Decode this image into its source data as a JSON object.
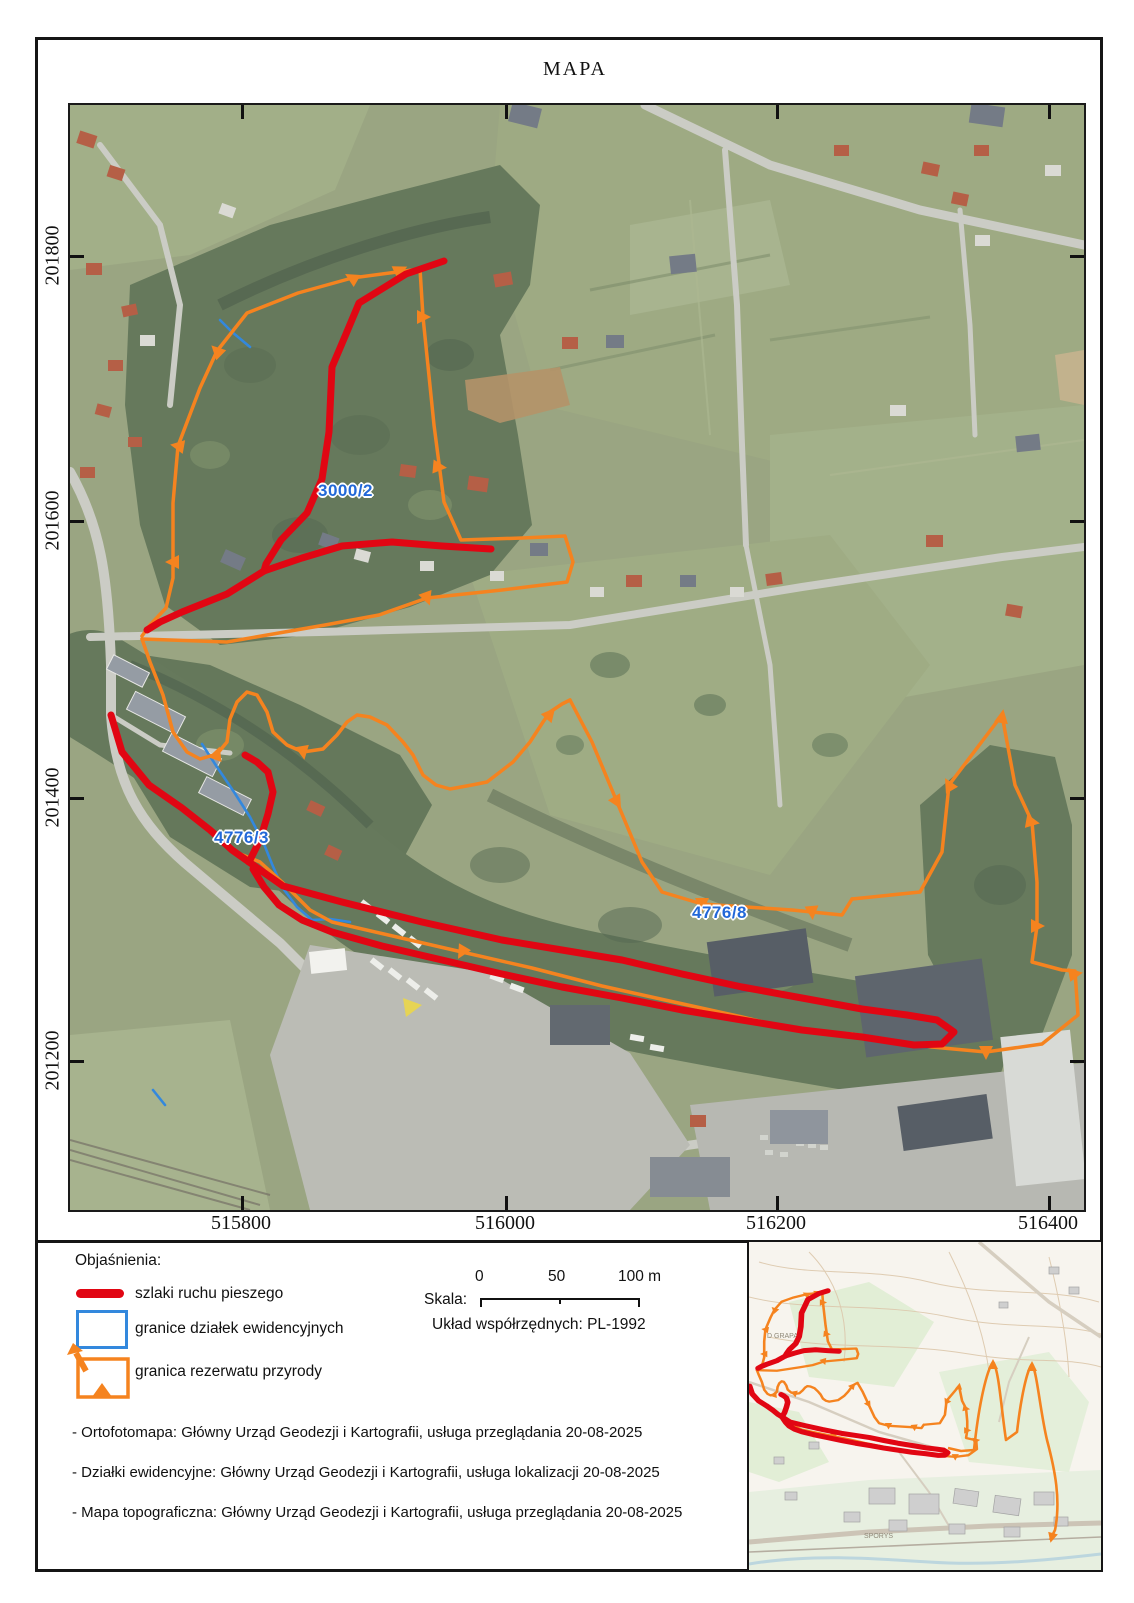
{
  "title": "MAPA",
  "axes": {
    "x_ticks": [
      "515800",
      "516000",
      "516200",
      "516400"
    ],
    "y_ticks": [
      "201800",
      "201600",
      "201400",
      "201200"
    ]
  },
  "map": {
    "parcel_labels": [
      {
        "text": "3000/2"
      },
      {
        "text": "4776/3"
      },
      {
        "text": "4776/8"
      }
    ]
  },
  "legend": {
    "heading": "Objaśnienia:",
    "items": [
      {
        "label": "szlaki ruchu pieszego"
      },
      {
        "label": "granice działek ewidencyjnych"
      },
      {
        "label": "granica rezerwatu przyrody"
      }
    ]
  },
  "scale": {
    "label": "Skala:",
    "tick0": "0",
    "tick50": "50",
    "tick100": "100 m",
    "crs": "Układ współrzędnych: PL-1992"
  },
  "sources": [
    "- Ortofotomapa: Główny Urząd Geodezji i Kartografii, usługa przeglądania 20-08-2025",
    "- Działki ewidencyjne: Główny Urząd Geodezji i Kartografii, usługa lokalizacji 20-08-2025",
    "- Mapa topograficzna: Główny Urząd Geodezji i Kartografii, usługa przeglądania 20-08-2025"
  ],
  "inset": {
    "labels": [
      {
        "text": "D GRAPA"
      },
      {
        "text": "SPORYS"
      }
    ]
  },
  "colors": {
    "trail_red": "#e10613",
    "reserve_orange": "#f5831f",
    "parcel_blue": "#3388dd",
    "label_blue": "#2268d8"
  }
}
